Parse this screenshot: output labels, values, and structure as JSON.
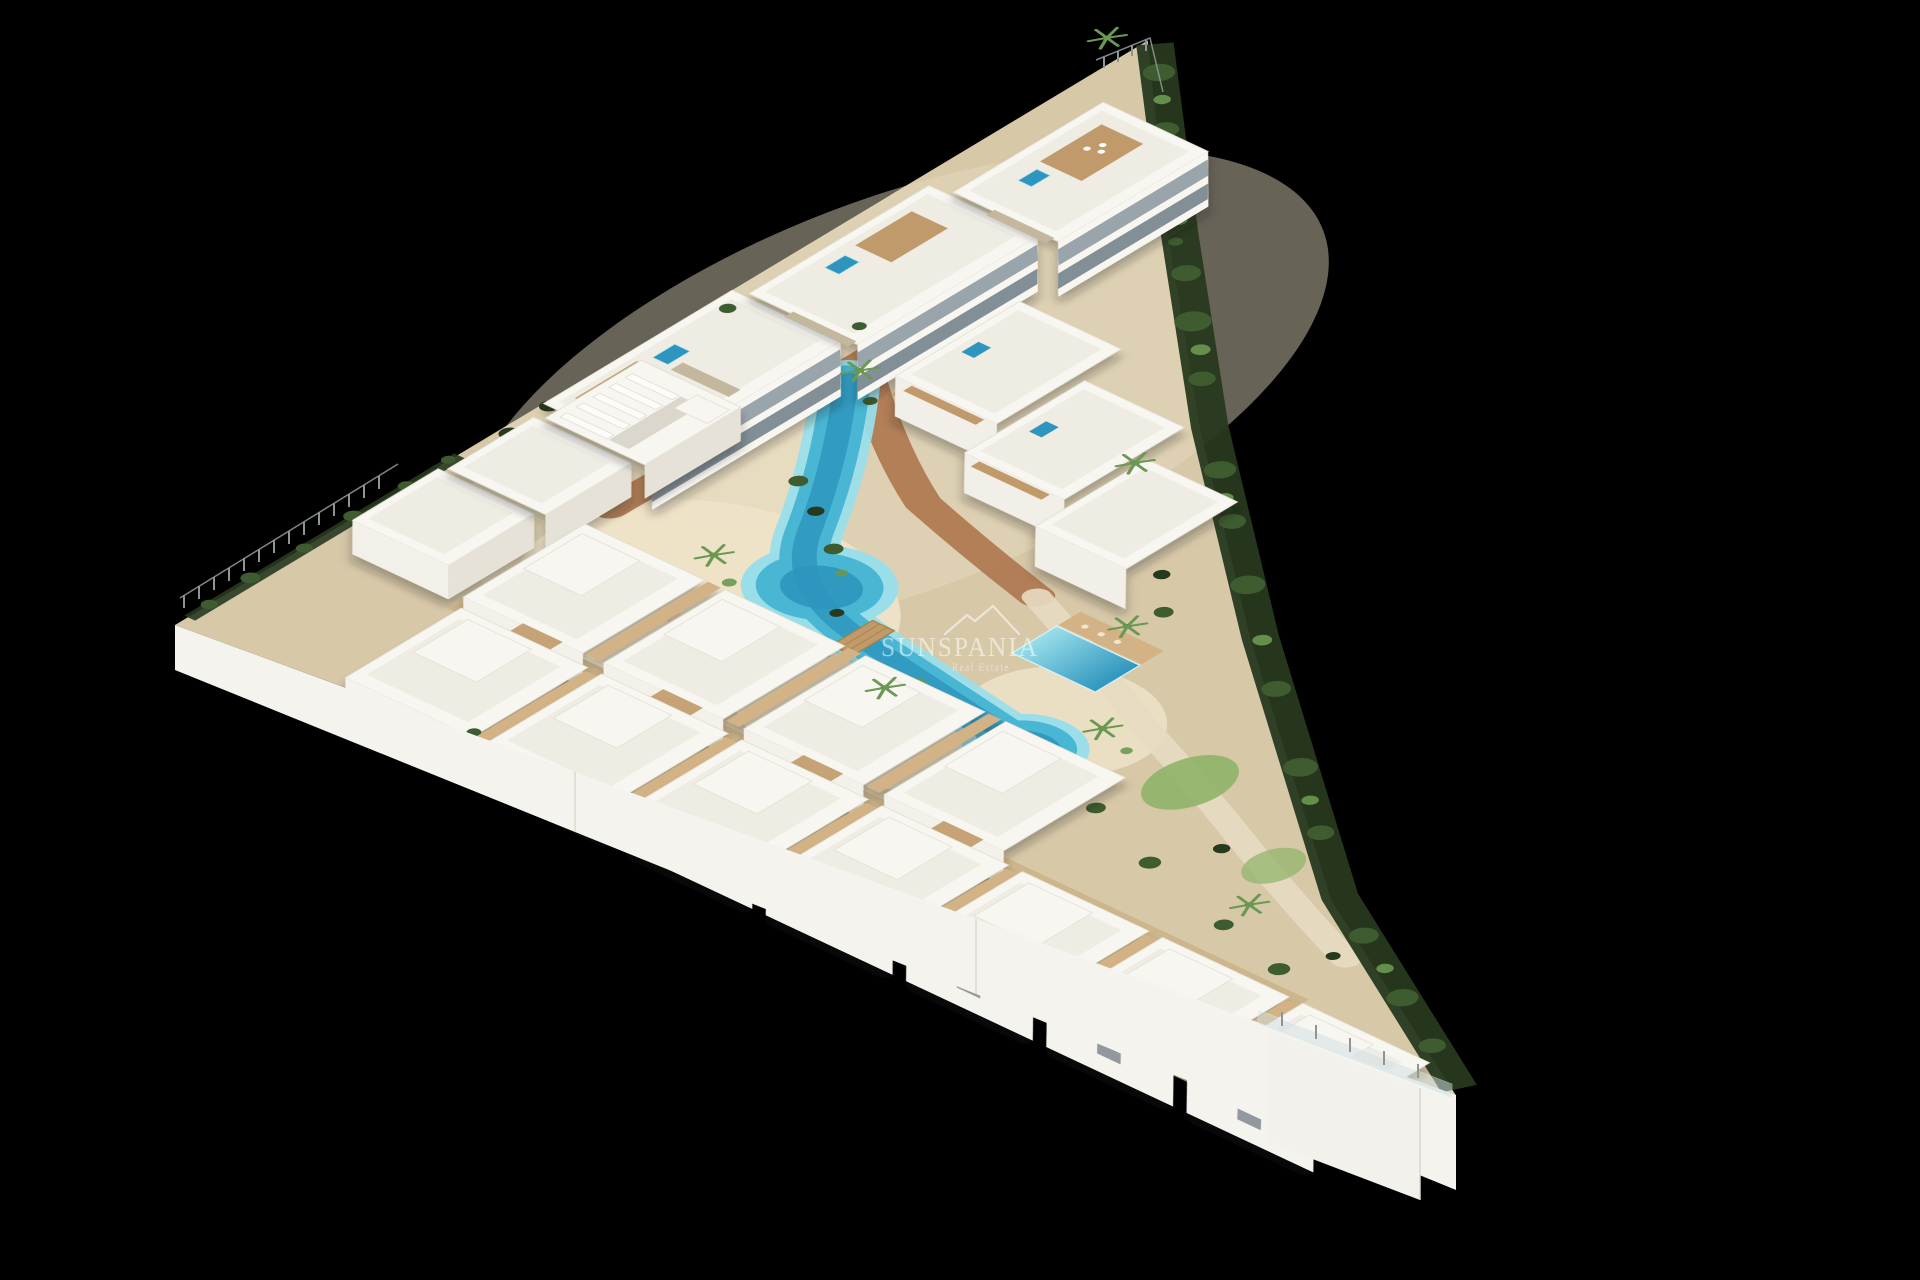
{
  "scene": {
    "description": "Aerial 3D architectural render of a triangular coastal residential complex on a black background: white modern apartment block and two staggered rows of white townhouses around a winding turquoise lagoon pool, sandy beach areas, terracotta paths, palm trees and perimeter hedges, with a semi-transparent real-estate watermark in the centre.",
    "background": "#000000",
    "watermark": {
      "brand": "SUNSPANIA",
      "tagline": "Real Estate",
      "icon": "house-roofs-icon"
    },
    "palette": {
      "bg": "#000000",
      "paving": "#d7c8a8",
      "paving_light": "#e7dcc2",
      "sand": "#eee3c8",
      "terracotta": "#b07a52",
      "wood": "#c09a6a",
      "wood_light": "#d3b285",
      "wood_dark": "#a9823f",
      "white_wall": "#f8f6f1",
      "white_roof": "#efece3",
      "wall_shade": "#e6e2d7",
      "balcony": "#9aa5ab",
      "balcony_dark": "#828f96",
      "stone": "#c3b79e",
      "pool_light": "#9adeea",
      "pool": "#49b6d4",
      "pool_deep": "#2e96be",
      "green_dark": "#27391f",
      "green": "#3e5c30",
      "green_light": "#6b9852",
      "grass": "#8fb468",
      "fence": "#8d9595",
      "glass": "#cfe0e3",
      "wm": "#ffffff"
    }
  }
}
